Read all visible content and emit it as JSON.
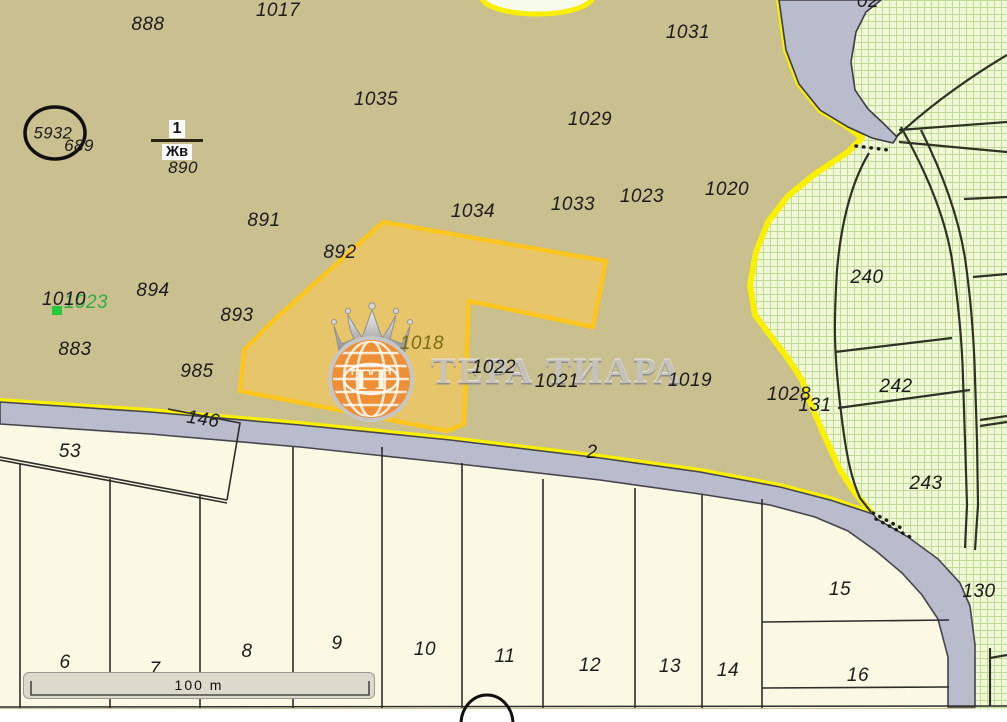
{
  "map": {
    "watermark": {
      "monogram": "ТТ",
      "brand": "ТЕРА ТИАРА"
    },
    "scale_bar": {
      "label": "100 m"
    },
    "fraction_label": {
      "numerator": "1",
      "denominator": "Жв"
    },
    "colors": {
      "field_tan": "#c9bf8f",
      "highlight_parcel_fill": "#e7c56b",
      "highlight_parcel_border": "#fcc61e",
      "boundary_yellow": "#f9ef00",
      "road_gray": "#b9bccd",
      "orchard_green_bg": "#f1f8d7",
      "orchard_grid": "#bedc95",
      "lowland_cream": "#fbf8e3",
      "green_label": "#2fae44",
      "green_marker": "#25cb3a",
      "highlight_label": "#7b6b13"
    },
    "labels": [
      {
        "text": "888",
        "x": 148,
        "y": 25,
        "kind": "parcel"
      },
      {
        "text": "1017",
        "x": 278,
        "y": 11,
        "kind": "parcel"
      },
      {
        "text": "1031",
        "x": 688,
        "y": 33,
        "kind": "parcel"
      },
      {
        "text": "1035",
        "x": 376,
        "y": 100,
        "kind": "parcel"
      },
      {
        "text": "1029",
        "x": 590,
        "y": 120,
        "kind": "parcel"
      },
      {
        "text": "5932",
        "x": 53,
        "y": 134,
        "kind": "circled"
      },
      {
        "text": "689",
        "x": 79,
        "y": 146,
        "kind": "small"
      },
      {
        "text": "890",
        "x": 183,
        "y": 168,
        "kind": "small"
      },
      {
        "text": "891",
        "x": 264,
        "y": 221,
        "kind": "parcel"
      },
      {
        "text": "1034",
        "x": 473,
        "y": 212,
        "kind": "parcel"
      },
      {
        "text": "1033",
        "x": 573,
        "y": 205,
        "kind": "parcel"
      },
      {
        "text": "1023",
        "x": 642,
        "y": 197,
        "kind": "parcel"
      },
      {
        "text": "1020",
        "x": 727,
        "y": 190,
        "kind": "parcel"
      },
      {
        "text": "892",
        "x": 340,
        "y": 253,
        "kind": "parcel"
      },
      {
        "text": "894",
        "x": 153,
        "y": 291,
        "kind": "parcel"
      },
      {
        "text": "1023",
        "x": 86,
        "y": 303,
        "kind": "green"
      },
      {
        "text": "1010",
        "x": 64,
        "y": 300,
        "kind": "parcel"
      },
      {
        "text": "893",
        "x": 237,
        "y": 316,
        "kind": "parcel"
      },
      {
        "text": "883",
        "x": 75,
        "y": 350,
        "kind": "parcel"
      },
      {
        "text": "985",
        "x": 197,
        "y": 372,
        "kind": "parcel"
      },
      {
        "text": "1018",
        "x": 422,
        "y": 344,
        "kind": "highlight"
      },
      {
        "text": "1022",
        "x": 494,
        "y": 368,
        "kind": "parcel"
      },
      {
        "text": "1021",
        "x": 557,
        "y": 382,
        "kind": "parcel"
      },
      {
        "text": "1019",
        "x": 690,
        "y": 381,
        "kind": "parcel"
      },
      {
        "text": "1028",
        "x": 789,
        "y": 395,
        "kind": "parcel"
      },
      {
        "text": "131",
        "x": 815,
        "y": 406,
        "kind": "parcel"
      },
      {
        "text": "146",
        "x": 203,
        "y": 420,
        "kind": "parcel",
        "rot": 9
      },
      {
        "text": "53",
        "x": 70,
        "y": 452,
        "kind": "parcel"
      },
      {
        "text": "2",
        "x": 592,
        "y": 453,
        "kind": "parcel"
      },
      {
        "text": "240",
        "x": 867,
        "y": 278,
        "kind": "parcel"
      },
      {
        "text": "242",
        "x": 896,
        "y": 387,
        "kind": "parcel"
      },
      {
        "text": "243",
        "x": 926,
        "y": 484,
        "kind": "parcel"
      },
      {
        "text": "130",
        "x": 979,
        "y": 592,
        "kind": "parcel"
      },
      {
        "text": "15",
        "x": 840,
        "y": 590,
        "kind": "parcel"
      },
      {
        "text": "16",
        "x": 858,
        "y": 676,
        "kind": "parcel"
      },
      {
        "text": "14",
        "x": 728,
        "y": 671,
        "kind": "parcel"
      },
      {
        "text": "13",
        "x": 670,
        "y": 667,
        "kind": "parcel"
      },
      {
        "text": "12",
        "x": 590,
        "y": 666,
        "kind": "parcel"
      },
      {
        "text": "11",
        "x": 505,
        "y": 657,
        "kind": "parcel"
      },
      {
        "text": "10",
        "x": 425,
        "y": 650,
        "kind": "parcel"
      },
      {
        "text": "9",
        "x": 337,
        "y": 644,
        "kind": "parcel"
      },
      {
        "text": "8",
        "x": 247,
        "y": 652,
        "kind": "parcel"
      },
      {
        "text": "7",
        "x": 155,
        "y": 670,
        "kind": "parcel"
      },
      {
        "text": "6",
        "x": 65,
        "y": 663,
        "kind": "parcel"
      },
      {
        "text": "02",
        "x": 868,
        "y": 2,
        "kind": "parcel"
      },
      {
        "text": "3",
        "x": -5,
        "y": 204,
        "kind": "parcel"
      }
    ]
  }
}
